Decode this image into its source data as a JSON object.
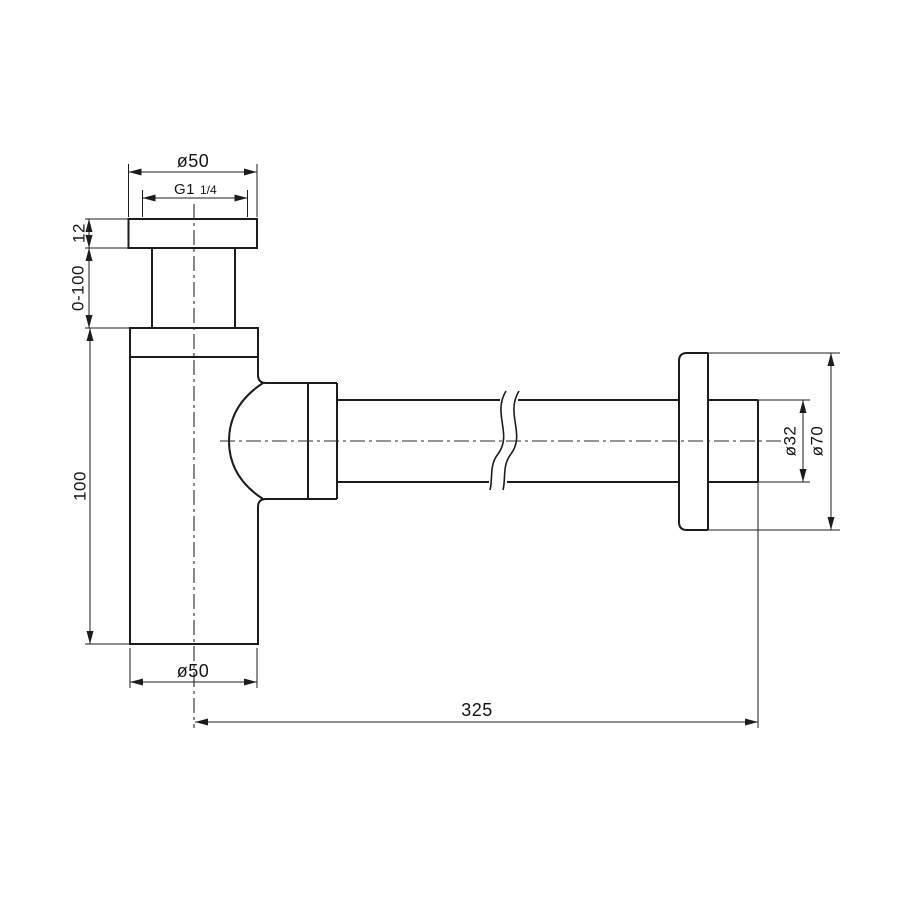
{
  "drawing": {
    "labels": {
      "inlet_diameter": "ø50",
      "thread_size": "G1",
      "thread_fraction": "1/4",
      "nut_height": "12",
      "adjustable_range": "0-100",
      "body_height": "100",
      "body_diameter": "ø50",
      "wall_distance": "325",
      "pipe_diameter": "ø32",
      "escutcheon_diameter": "ø70"
    },
    "line_color": "#1c1c1c",
    "background_color": "#ffffff"
  }
}
